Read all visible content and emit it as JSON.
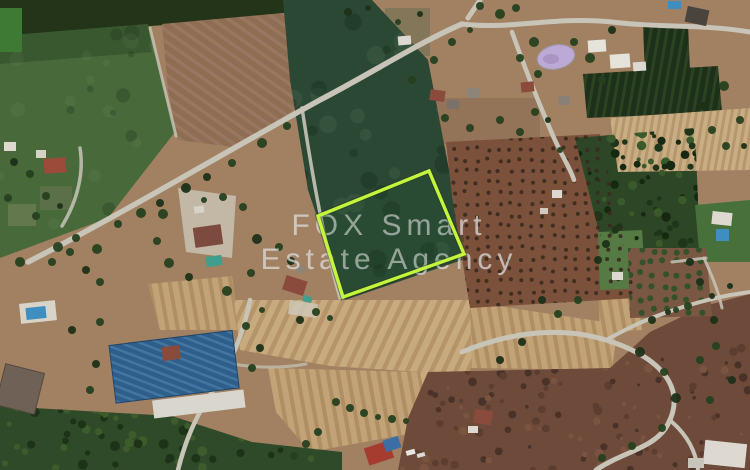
{
  "image": {
    "type": "satellite-aerial-photo",
    "subject": "Aerial view of agricultural land and rural plots with one plot for sale highlighted by a bright green boundary",
    "width_px": 750,
    "height_px": 470
  },
  "watermark": {
    "line1": "FOX Smart",
    "line2": "Estate Agency"
  },
  "plot": {
    "shape": "quadrilateral",
    "points": "318,216 429,171 464,254 343,297"
  },
  "colors": {
    "plot-outline": "#c3f53c",
    "watermark-text": "#e0e0e0",
    "field-green-dark": "#2b4834",
    "field-green-light": "#486a3b",
    "plowed-brown": "#8f6d53",
    "harvest-tan": "#c7aa7e",
    "scrub-brown": "#6d4a39",
    "orchard-brown": "#7c513c",
    "orchard-green": "#2c4626",
    "lawn-green": "#47703a",
    "road-gray": "#c8c4b8",
    "warehouse-roof-blue": "#2e5e8c",
    "pool-blue": "#3e8ec0",
    "pool-teal": "#3f9e8e",
    "pond-purple": "#bda9d6",
    "roof-red": "#8a4a3c",
    "base-tan": "#a18162"
  },
  "features": [
    "highlighted-plot-boundary",
    "dark-green-field",
    "plowed-brown-field",
    "olive-tree-orchard",
    "dense-green-orchard",
    "harvested-striped-fields",
    "scrubland",
    "main-road",
    "blue-roof-warehouse",
    "farmhouses-with-red-roofs",
    "swimming-pools",
    "purple-pond",
    "tree-rows-along-roads"
  ]
}
